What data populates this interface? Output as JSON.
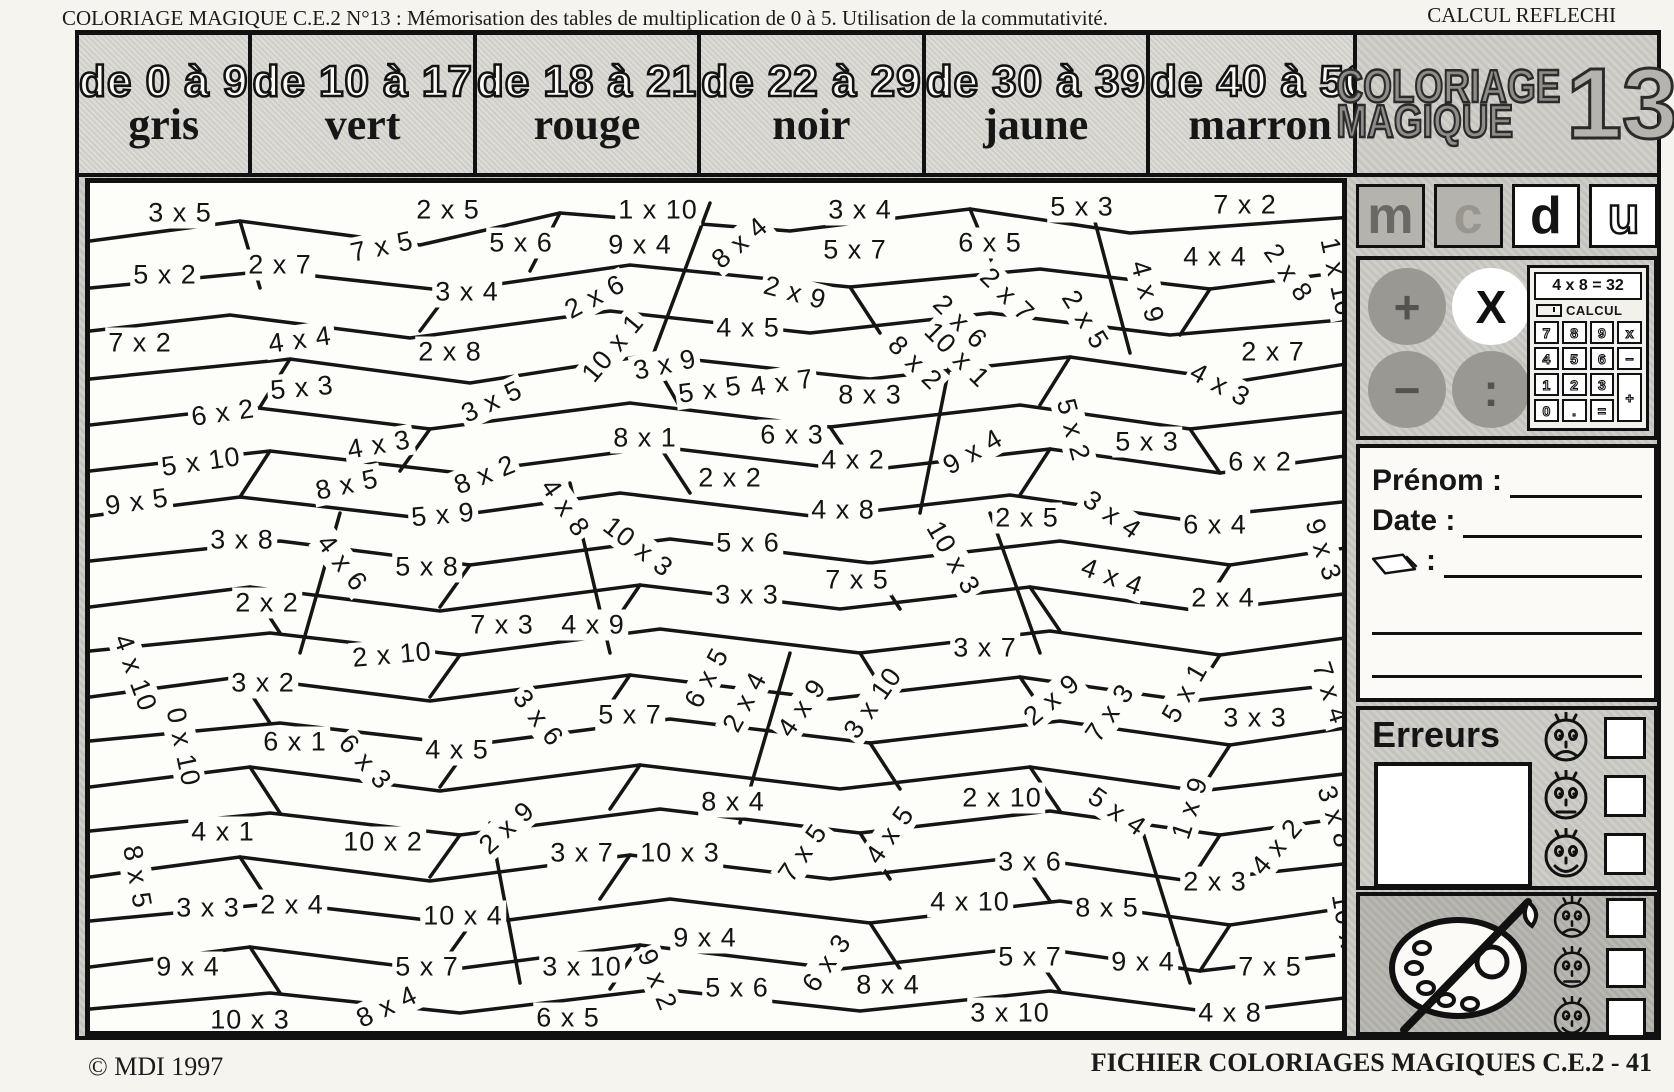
{
  "header": {
    "title_left": "COLORIAGE MAGIQUE C.E.2  N°13 : Mémorisation des tables de multiplication de 0 à 5. Utilisation de la commutativité.",
    "title_right": "CALCUL REFLECHI"
  },
  "legend": [
    {
      "range": "de 0 à 9",
      "color_name": "gris"
    },
    {
      "range": "de 10 à 17",
      "color_name": "vert"
    },
    {
      "range": "de 18 à 21",
      "color_name": "rouge"
    },
    {
      "range": "de 22 à 29",
      "color_name": "noir"
    },
    {
      "range": "de 30 à 39",
      "color_name": "jaune"
    },
    {
      "range": "de 40 à 50",
      "color_name": "marron"
    }
  ],
  "title_panel": {
    "line1": "COLORIAGE",
    "line2": "MAGIQUE",
    "number": "13"
  },
  "place_value_letters": [
    "m",
    "c",
    "d",
    "u"
  ],
  "operations": [
    {
      "symbol": "+",
      "style": "gray"
    },
    {
      "symbol": "X",
      "style": "white"
    },
    {
      "symbol": "−",
      "style": "gray"
    },
    {
      "symbol": ":",
      "style": "gray"
    }
  ],
  "calculator": {
    "display": "4 x 8 = 32",
    "label": "CALCUL",
    "keys": [
      "7",
      "8",
      "9",
      "x",
      "4",
      "5",
      "6",
      "−",
      "1",
      "2",
      "3",
      "+",
      "0",
      ".",
      "="
    ]
  },
  "form": {
    "prenom_label": "Prénom :",
    "date_label": "Date :",
    "pencil_label": ":"
  },
  "erreurs": {
    "label": "Erreurs",
    "faces": [
      "sad",
      "neutral",
      "happy"
    ]
  },
  "palette": {
    "faces": [
      "sad",
      "neutral",
      "happy"
    ]
  },
  "footer": {
    "left": "© MDI 1997",
    "right": "FICHIER COLORIAGES MAGIQUES C.E.2  - 41"
  },
  "colors": {
    "ink": "#111111",
    "panel_gray": "#c7c5bf",
    "dark_gray": "#b0aea8",
    "paper": "#fdfdfa"
  },
  "puzzle": {
    "cells": [
      {
        "t": "3 x 5",
        "x": 175,
        "y": 208,
        "r": 0
      },
      {
        "t": "2 x 5",
        "x": 443,
        "y": 205,
        "r": 0
      },
      {
        "t": "1 x 10",
        "x": 653,
        "y": 205,
        "r": 0
      },
      {
        "t": "3 x 4",
        "x": 855,
        "y": 205,
        "r": 0
      },
      {
        "t": "5 x 3",
        "x": 1077,
        "y": 202,
        "r": 0
      },
      {
        "t": "7 x 2",
        "x": 1240,
        "y": 200,
        "r": 0
      },
      {
        "t": "5 x 2",
        "x": 160,
        "y": 270,
        "r": 0
      },
      {
        "t": "2 x 7",
        "x": 275,
        "y": 260,
        "r": 0
      },
      {
        "t": "7 x 5",
        "x": 377,
        "y": 242,
        "r": -12
      },
      {
        "t": "5 x 6",
        "x": 516,
        "y": 238,
        "r": 0
      },
      {
        "t": "9 x 4",
        "x": 635,
        "y": 240,
        "r": 0
      },
      {
        "t": "8 x 4",
        "x": 735,
        "y": 238,
        "r": -40
      },
      {
        "t": "5 x 7",
        "x": 850,
        "y": 245,
        "r": 0
      },
      {
        "t": "6 x 5",
        "x": 985,
        "y": 238,
        "r": 0
      },
      {
        "t": "4 x 4",
        "x": 1210,
        "y": 252,
        "r": 0
      },
      {
        "t": "2 x 8",
        "x": 1283,
        "y": 268,
        "r": 55
      },
      {
        "t": "1 x 10",
        "x": 1332,
        "y": 272,
        "r": 78
      },
      {
        "t": "3 x 4",
        "x": 462,
        "y": 287,
        "r": 0
      },
      {
        "t": "2 x 6",
        "x": 590,
        "y": 292,
        "r": -28
      },
      {
        "t": "2 x 9",
        "x": 790,
        "y": 288,
        "r": 15
      },
      {
        "t": "2 x 7",
        "x": 1002,
        "y": 290,
        "r": 45
      },
      {
        "t": "2 x 6",
        "x": 955,
        "y": 317,
        "r": 45
      },
      {
        "t": "2 x 5",
        "x": 1080,
        "y": 315,
        "r": 58
      },
      {
        "t": "4 x 9",
        "x": 1142,
        "y": 287,
        "r": 75
      },
      {
        "t": "7 x 2",
        "x": 135,
        "y": 338,
        "r": 0
      },
      {
        "t": "4 x 4",
        "x": 295,
        "y": 335,
        "r": -8
      },
      {
        "t": "2 x 8",
        "x": 445,
        "y": 347,
        "r": 0
      },
      {
        "t": "10 x 1",
        "x": 608,
        "y": 343,
        "r": -50
      },
      {
        "t": "4 x 5",
        "x": 743,
        "y": 323,
        "r": 0
      },
      {
        "t": "3 x 9",
        "x": 660,
        "y": 360,
        "r": -12
      },
      {
        "t": "8 x 2",
        "x": 910,
        "y": 358,
        "r": 45
      },
      {
        "t": "10 x 1",
        "x": 952,
        "y": 350,
        "r": 45
      },
      {
        "t": "2 x 7",
        "x": 1268,
        "y": 347,
        "r": 0
      },
      {
        "t": "5 x 3",
        "x": 297,
        "y": 383,
        "r": -5
      },
      {
        "t": "3 x 5",
        "x": 487,
        "y": 397,
        "r": -25
      },
      {
        "t": "5 x 5",
        "x": 705,
        "y": 385,
        "r": -8
      },
      {
        "t": "4 x 7",
        "x": 777,
        "y": 378,
        "r": -8
      },
      {
        "t": "8 x 3",
        "x": 865,
        "y": 390,
        "r": 0
      },
      {
        "t": "4 x 3",
        "x": 1215,
        "y": 380,
        "r": 28
      },
      {
        "t": "6 x 2",
        "x": 218,
        "y": 408,
        "r": -8
      },
      {
        "t": "4 x 3",
        "x": 374,
        "y": 440,
        "r": -10
      },
      {
        "t": "8 x 1",
        "x": 640,
        "y": 433,
        "r": 0
      },
      {
        "t": "6 x 3",
        "x": 787,
        "y": 430,
        "r": 0
      },
      {
        "t": "4 x 2",
        "x": 848,
        "y": 455,
        "r": 0
      },
      {
        "t": "5 x 2",
        "x": 1068,
        "y": 425,
        "r": 75
      },
      {
        "t": "5 x 3",
        "x": 1142,
        "y": 437,
        "r": 0
      },
      {
        "t": "6 x 2",
        "x": 1255,
        "y": 457,
        "r": 0
      },
      {
        "t": "9 x 4",
        "x": 968,
        "y": 447,
        "r": -30
      },
      {
        "t": "5 x 10",
        "x": 196,
        "y": 457,
        "r": -8
      },
      {
        "t": "9 x 5",
        "x": 132,
        "y": 497,
        "r": -8
      },
      {
        "t": "8 x 5",
        "x": 342,
        "y": 480,
        "r": -12
      },
      {
        "t": "8 x 2",
        "x": 480,
        "y": 470,
        "r": -22
      },
      {
        "t": "5 x 9",
        "x": 438,
        "y": 510,
        "r": -5
      },
      {
        "t": "2 x 2",
        "x": 725,
        "y": 473,
        "r": 0
      },
      {
        "t": "4 x 8",
        "x": 560,
        "y": 503,
        "r": 55
      },
      {
        "t": "4 x 8",
        "x": 838,
        "y": 505,
        "r": 0
      },
      {
        "t": "2 x 5",
        "x": 1022,
        "y": 513,
        "r": 0
      },
      {
        "t": "3 x 4",
        "x": 1107,
        "y": 510,
        "r": 35
      },
      {
        "t": "6 x 4",
        "x": 1210,
        "y": 520,
        "r": 0
      },
      {
        "t": "3 x 8",
        "x": 237,
        "y": 535,
        "r": 0
      },
      {
        "t": "4 x 6",
        "x": 337,
        "y": 558,
        "r": 52
      },
      {
        "t": "5 x 8",
        "x": 422,
        "y": 562,
        "r": 0
      },
      {
        "t": "10 x 3",
        "x": 633,
        "y": 542,
        "r": 38
      },
      {
        "t": "5 x 6",
        "x": 743,
        "y": 538,
        "r": 0
      },
      {
        "t": "7 x 5",
        "x": 852,
        "y": 575,
        "r": 0
      },
      {
        "t": "10 x 3",
        "x": 948,
        "y": 553,
        "r": 60
      },
      {
        "t": "4 x 4",
        "x": 1107,
        "y": 572,
        "r": 20
      },
      {
        "t": "9 x 3",
        "x": 1318,
        "y": 545,
        "r": 72
      },
      {
        "t": "2 x 2",
        "x": 262,
        "y": 598,
        "r": 0
      },
      {
        "t": "3 x 3",
        "x": 742,
        "y": 590,
        "r": 0
      },
      {
        "t": "2 x 4",
        "x": 1218,
        "y": 593,
        "r": 0
      },
      {
        "t": "2 x 10",
        "x": 387,
        "y": 650,
        "r": -5
      },
      {
        "t": "4 x 10",
        "x": 130,
        "y": 668,
        "r": 70
      },
      {
        "t": "3 x 2",
        "x": 258,
        "y": 678,
        "r": 0
      },
      {
        "t": "4 x 9",
        "x": 588,
        "y": 620,
        "r": 0
      },
      {
        "t": "7 x 3",
        "x": 497,
        "y": 620,
        "r": 0
      },
      {
        "t": "3 x 7",
        "x": 980,
        "y": 643,
        "r": 0
      },
      {
        "t": "6 x 5",
        "x": 702,
        "y": 673,
        "r": -62
      },
      {
        "t": "2 x 4",
        "x": 740,
        "y": 697,
        "r": -62
      },
      {
        "t": "5 x 1",
        "x": 1180,
        "y": 688,
        "r": -60
      },
      {
        "t": "2 x 9",
        "x": 1047,
        "y": 695,
        "r": -40
      },
      {
        "t": "7 x 3",
        "x": 1105,
        "y": 708,
        "r": -55
      },
      {
        "t": "3 x 3",
        "x": 1250,
        "y": 713,
        "r": 0
      },
      {
        "t": "7 x 4",
        "x": 1325,
        "y": 688,
        "r": 72
      },
      {
        "t": "0 x 10",
        "x": 178,
        "y": 742,
        "r": 78
      },
      {
        "t": "6 x 1",
        "x": 290,
        "y": 737,
        "r": 0
      },
      {
        "t": "6 x 3",
        "x": 360,
        "y": 757,
        "r": 48
      },
      {
        "t": "4 x 5",
        "x": 452,
        "y": 745,
        "r": 0
      },
      {
        "t": "5 x 7",
        "x": 625,
        "y": 710,
        "r": 0
      },
      {
        "t": "3 x 6",
        "x": 533,
        "y": 713,
        "r": 52
      },
      {
        "t": "4 x 9",
        "x": 797,
        "y": 703,
        "r": -55
      },
      {
        "t": "3 x 10",
        "x": 868,
        "y": 698,
        "r": -55
      },
      {
        "t": "4 x 1",
        "x": 218,
        "y": 827,
        "r": 0
      },
      {
        "t": "8 x 5",
        "x": 132,
        "y": 872,
        "r": 80
      },
      {
        "t": "10 x 2",
        "x": 378,
        "y": 837,
        "r": 0
      },
      {
        "t": "2 x 9",
        "x": 502,
        "y": 823,
        "r": -42
      },
      {
        "t": "2 x 10",
        "x": 997,
        "y": 793,
        "r": 0
      },
      {
        "t": "5 x 4",
        "x": 1112,
        "y": 807,
        "r": 35
      },
      {
        "t": "1 x 9",
        "x": 1185,
        "y": 803,
        "r": -72
      },
      {
        "t": "4 x 2",
        "x": 1272,
        "y": 842,
        "r": -50
      },
      {
        "t": "3 x 8",
        "x": 1330,
        "y": 812,
        "r": 72
      },
      {
        "t": "8 x 4",
        "x": 728,
        "y": 797,
        "r": 0
      },
      {
        "t": "10 x 3",
        "x": 675,
        "y": 848,
        "r": 0
      },
      {
        "t": "3 x 7",
        "x": 577,
        "y": 848,
        "r": 0
      },
      {
        "t": "7 x 5",
        "x": 798,
        "y": 848,
        "r": -55
      },
      {
        "t": "4 x 5",
        "x": 885,
        "y": 830,
        "r": -55
      },
      {
        "t": "3 x 3",
        "x": 203,
        "y": 903,
        "r": 0
      },
      {
        "t": "2 x 4",
        "x": 287,
        "y": 900,
        "r": 0
      },
      {
        "t": "10 x 4",
        "x": 458,
        "y": 911,
        "r": 0
      },
      {
        "t": "3 x 6",
        "x": 1025,
        "y": 857,
        "r": 0
      },
      {
        "t": "2 x 3",
        "x": 1210,
        "y": 877,
        "r": 0
      },
      {
        "t": "4 x 10",
        "x": 965,
        "y": 897,
        "r": 0
      },
      {
        "t": "8 x 5",
        "x": 1102,
        "y": 903,
        "r": 0
      },
      {
        "t": "10 x 5",
        "x": 1342,
        "y": 928,
        "r": 80
      },
      {
        "t": "9 x 4",
        "x": 183,
        "y": 962,
        "r": 0
      },
      {
        "t": "5 x 7",
        "x": 422,
        "y": 962,
        "r": 0
      },
      {
        "t": "8 x 4",
        "x": 382,
        "y": 1002,
        "r": -25
      },
      {
        "t": "10 x 3",
        "x": 245,
        "y": 1015,
        "r": 0
      },
      {
        "t": "9 x 4",
        "x": 700,
        "y": 933,
        "r": 0
      },
      {
        "t": "3 x 10",
        "x": 577,
        "y": 962,
        "r": 0
      },
      {
        "t": "9 x 2",
        "x": 652,
        "y": 975,
        "r": 68
      },
      {
        "t": "5 x 6",
        "x": 732,
        "y": 983,
        "r": 0
      },
      {
        "t": "6 x 3",
        "x": 822,
        "y": 958,
        "r": -55
      },
      {
        "t": "8 x 4",
        "x": 883,
        "y": 980,
        "r": 0
      },
      {
        "t": "6 x 5",
        "x": 563,
        "y": 1013,
        "r": 0
      },
      {
        "t": "5 x 7",
        "x": 1025,
        "y": 952,
        "r": 0
      },
      {
        "t": "9 x 4",
        "x": 1138,
        "y": 957,
        "r": 0
      },
      {
        "t": "7 x 5",
        "x": 1265,
        "y": 962,
        "r": 0
      },
      {
        "t": "3 x 10",
        "x": 1005,
        "y": 1008,
        "r": 0
      },
      {
        "t": "4 x 8",
        "x": 1225,
        "y": 1008,
        "r": 0
      }
    ]
  }
}
